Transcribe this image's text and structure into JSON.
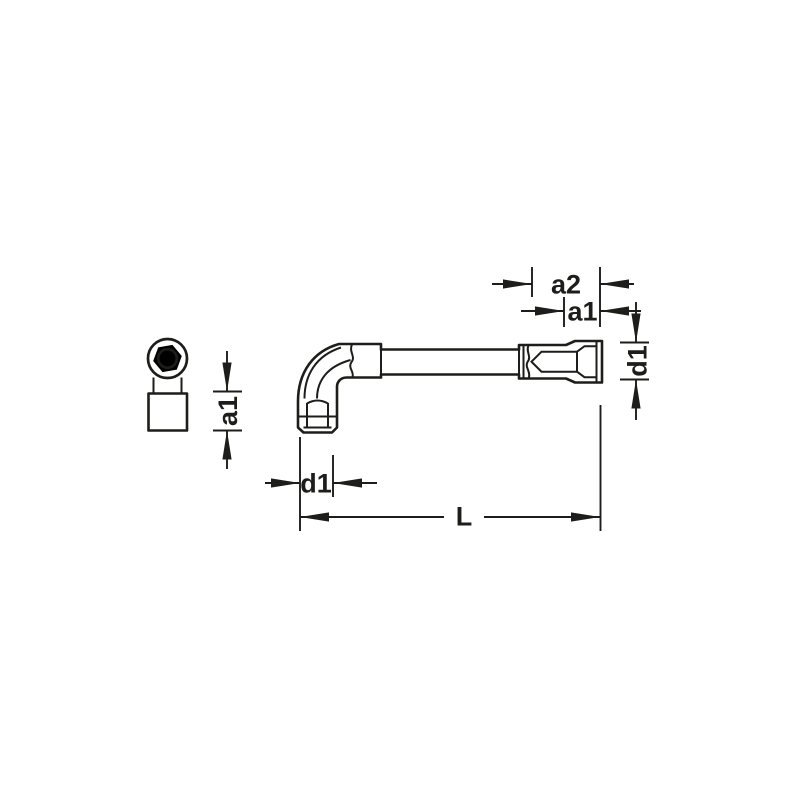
{
  "figure": {
    "views": {
      "end": "socket-end-view",
      "side": "l-wrench-side-view"
    },
    "labels": {
      "a2": "a2",
      "a1_top": "a1",
      "d1_right": "d1",
      "a1_left": "a1",
      "d1_bottom": "d1",
      "length": "L"
    },
    "colors": {
      "line": "#1d1d1b",
      "background": "#ffffff"
    }
  }
}
